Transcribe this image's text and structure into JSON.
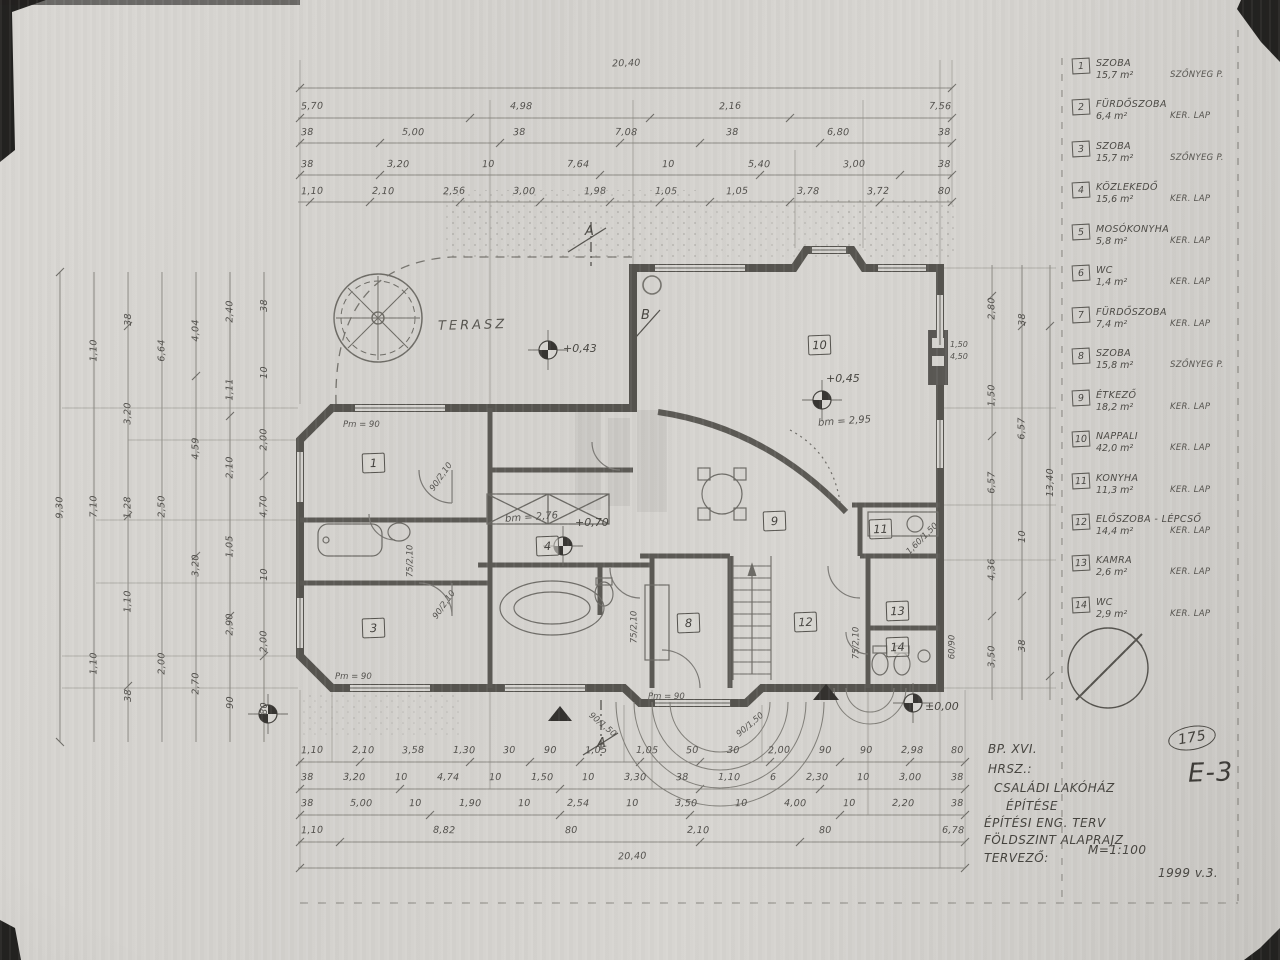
{
  "plan": {
    "terrace_label": "TERASZ",
    "room_markers": [
      "1",
      "3",
      "4",
      "8",
      "9",
      "10",
      "11",
      "12",
      "13",
      "14"
    ],
    "section_markers": [
      "A",
      "B",
      "A"
    ],
    "elevations": [
      "+0,43",
      "+0,45",
      "+0,70",
      "±0,00"
    ],
    "heights": [
      "bm = 2,95",
      "bm = 2,76"
    ],
    "annotations": [
      "Pm = 90",
      "Pm = 90",
      "Pm = 90",
      "90/2,10",
      "75/2,10",
      "90/2,10",
      "75/2,10",
      "75/2,10",
      "1,60/1,50",
      "60/90",
      "90/1,50",
      "90/1,50",
      "1,50",
      "4,50"
    ]
  },
  "dims": {
    "top": {
      "r1": [
        "20,40"
      ],
      "r2": [
        "5,70",
        "4,98",
        "2,16",
        "7,56"
      ],
      "r3": [
        "38",
        "5,00",
        "38",
        "7,08",
        "38",
        "6,80",
        "38"
      ],
      "r4": [
        "38",
        "3,20",
        "10",
        "7,64",
        "10",
        "5,40",
        "3,00",
        "38"
      ],
      "r5": [
        "1,10",
        "2,10",
        "2,56",
        "3,00",
        "1,98",
        "1,05",
        "1,05",
        "3,78",
        "3,72",
        "80"
      ]
    },
    "bottom": {
      "r1": [
        "1,10",
        "2,10",
        "3,58",
        "1,30",
        "30",
        "90",
        "1,05",
        "1,05",
        "50",
        "30",
        "2,00",
        "90",
        "90",
        "2,98",
        "80"
      ],
      "r2": [
        "38",
        "3,20",
        "10",
        "4,74",
        "10",
        "1,50",
        "10",
        "3,30",
        "38",
        "1,10",
        "6",
        "2,30",
        "10",
        "3,00",
        "38"
      ],
      "r3": [
        "38",
        "5,00",
        "10",
        "1,90",
        "10",
        "2,54",
        "10",
        "3,50",
        "10",
        "4,00",
        "10",
        "2,20",
        "38"
      ],
      "r4": [
        "1,10",
        "8,82",
        "80",
        "2,10",
        "80",
        "6,78"
      ],
      "r5": [
        "20,40"
      ]
    },
    "left": {
      "c1": [
        "9,30"
      ],
      "c2": [
        "1,10",
        "7,10",
        "1,10"
      ],
      "c3": [
        "38",
        "3,20",
        "1,28",
        "1,10",
        "38"
      ],
      "c4": [
        "6,64",
        "2,50",
        "2,00"
      ],
      "c5": [
        "4,04",
        "4,59",
        "3,20",
        "2,70"
      ],
      "c6": [
        "2,40",
        "1,11",
        "2,10",
        "1,05",
        "2,90",
        "90"
      ],
      "c7": [
        "38",
        "10",
        "2,00",
        "4,70",
        "10",
        "2,00",
        "80"
      ]
    },
    "right": {
      "c1": [
        "2,80",
        "1,50",
        "6,57",
        "4,36",
        "3,50"
      ],
      "c2": [
        "38",
        "6,57",
        "10",
        "38"
      ],
      "c3": [
        "13,40"
      ]
    }
  },
  "legend": {
    "items": [
      {
        "num": "1",
        "name": "SZOBA",
        "area": "15,7 m²",
        "finish": "SZŐNYEG P."
      },
      {
        "num": "2",
        "name": "FÜRDŐSZOBA",
        "area": "6,4 m²",
        "finish": "KER. LAP"
      },
      {
        "num": "3",
        "name": "SZOBA",
        "area": "15,7 m²",
        "finish": "SZŐNYEG P."
      },
      {
        "num": "4",
        "name": "KÖZLEKEDŐ",
        "area": "15,6 m²",
        "finish": "KER. LAP"
      },
      {
        "num": "5",
        "name": "MOSÓKONYHA",
        "area": "5,8 m²",
        "finish": "KER. LAP"
      },
      {
        "num": "6",
        "name": "WC",
        "area": "1,4 m²",
        "finish": "KER. LAP"
      },
      {
        "num": "7",
        "name": "FÜRDŐSZOBA",
        "area": "7,4 m²",
        "finish": "KER. LAP"
      },
      {
        "num": "8",
        "name": "SZOBA",
        "area": "15,8 m²",
        "finish": "SZŐNYEG P."
      },
      {
        "num": "9",
        "name": "ÉTKEZŐ",
        "area": "18,2 m²",
        "finish": "KER. LAP"
      },
      {
        "num": "10",
        "name": "NAPPALI",
        "area": "42,0 m²",
        "finish": "KER. LAP"
      },
      {
        "num": "11",
        "name": "KONYHA",
        "area": "11,3 m²",
        "finish": "KER. LAP"
      },
      {
        "num": "12",
        "name": "ELŐSZOBA - LÉPCSŐ",
        "area": "14,4 m²",
        "finish": "KER. LAP"
      },
      {
        "num": "13",
        "name": "KAMRA",
        "area": "2,6 m²",
        "finish": "KER. LAP"
      },
      {
        "num": "14",
        "name": "WC",
        "area": "2,9 m²",
        "finish": "KER. LAP"
      }
    ]
  },
  "title_block": {
    "city": "BP. XVI.",
    "parcel": "HRSZ.:",
    "project1": "CSALÁDI LAKÓHÁZ",
    "project2": "ÉPÍTÉSE",
    "doc_type": "ÉPÍTÉSI ENG. TERV",
    "drawing": "FÖLDSZINT ALAPRAJZ",
    "designer": "TERVEZŐ:",
    "scale": "M=1:100",
    "sheet": "E-3",
    "number": "175",
    "date": "1999 v.3."
  }
}
